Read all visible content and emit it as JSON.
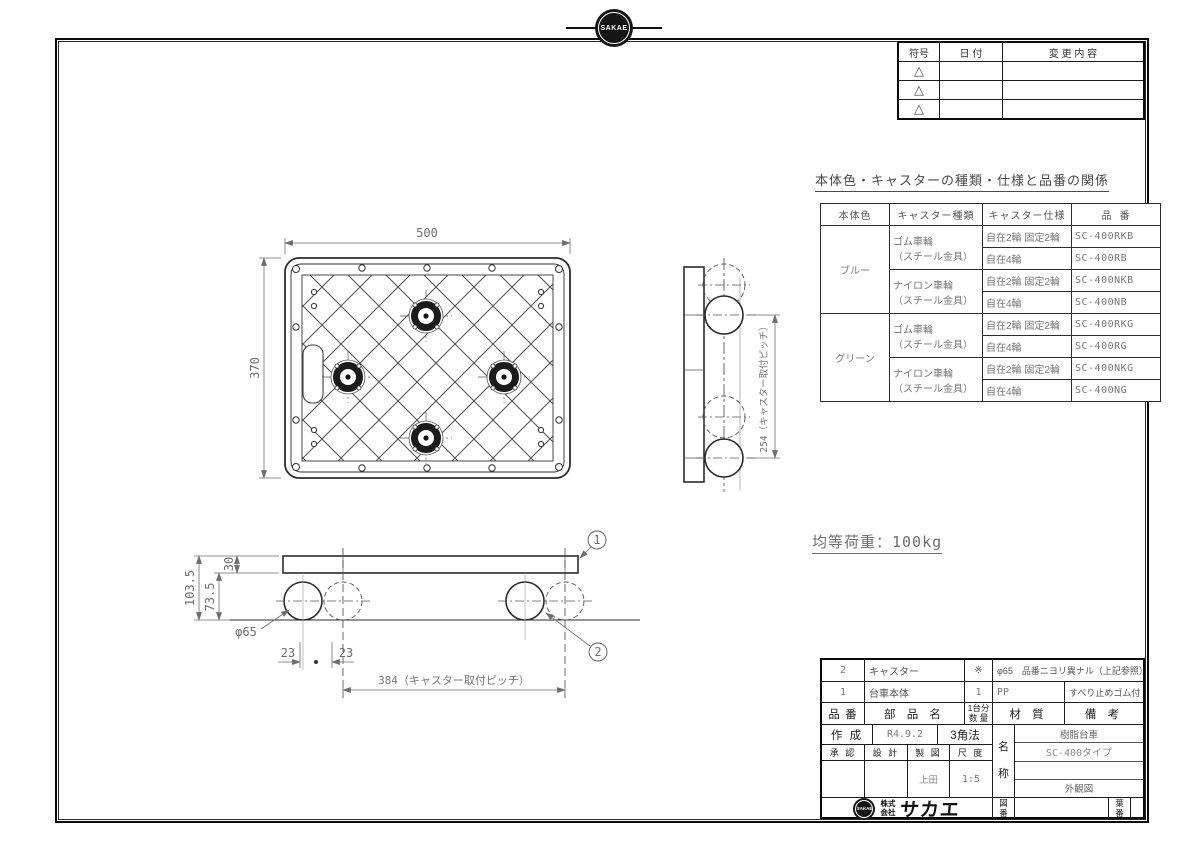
{
  "company": {
    "stamp": "SAKAE",
    "kabushiki": "株式",
    "kaisha": "会社",
    "name": "サカエ"
  },
  "revision_table": {
    "headers": {
      "symbol": "符号",
      "date": "日 付",
      "change": "変 更 内 容"
    },
    "mark": "△"
  },
  "spec_section": {
    "title": "本体色・キャスターの種類・仕様と品番の関係",
    "headers": [
      "本体色",
      "キャスター種類",
      "キャスター仕様",
      "品 番"
    ],
    "rows": [
      {
        "color": "ブルー",
        "type1": "ゴム車輪",
        "type2": "（スチール金具）",
        "spec": "自在2輪 固定2輪",
        "part": "SC-400RKB"
      },
      {
        "spec": "自在4輪",
        "part": "SC-400RB"
      },
      {
        "type1": "ナイロン車輪",
        "type2": "（スチール金具）",
        "spec": "自在2輪 固定2輪",
        "part": "SC-400NKB"
      },
      {
        "spec": "自在4輪",
        "part": "SC-400NB"
      },
      {
        "color": "グリーン",
        "type1": "ゴム車輪",
        "type2": "（スチール金具）",
        "spec": "自在2輪 固定2輪",
        "part": "SC-400RKG"
      },
      {
        "spec": "自在4輪",
        "part": "SC-400RG"
      },
      {
        "type1": "ナイロン車輪",
        "type2": "（スチール金具）",
        "spec": "自在2輪 固定2輪",
        "part": "SC-400NKG"
      },
      {
        "spec": "自在4輪",
        "part": "SC-400NG"
      }
    ]
  },
  "notes": {
    "load": "均等荷重：100kg"
  },
  "parts_table": {
    "headers": {
      "no": "品 番",
      "name": "部 品 名",
      "qty1": "1台分",
      "qty2": "数 量",
      "material": "材   質",
      "remarks": "備   考"
    },
    "rows": [
      {
        "no": "2",
        "name": "キャスター",
        "qty": "※",
        "material": "φ65　品番ニヨリ異ナル（上記参照）",
        "remarks": ""
      },
      {
        "no": "1",
        "name": "台車本体",
        "qty": "1",
        "material": "PP",
        "remarks": "すべり止めゴム付"
      }
    ]
  },
  "title_block": {
    "created_label": "作 成",
    "created_date": "R4.9.2",
    "projection": "3角法",
    "approved_label": "承 認",
    "design_label": "設 計",
    "draft_label": "製 図",
    "scale_label": "尺 度",
    "draft_name": "上田",
    "scale": "1:5",
    "name_label_1": "名",
    "name_label_2": "称",
    "product_name": "樹脂台車",
    "model": "SC-400タイプ",
    "view_type": "外観図",
    "dwg_no_label_1": "図",
    "dwg_no_label_2": "番",
    "sheet_label_1": "葉",
    "sheet_label_2": "番"
  },
  "drawing": {
    "top_view": {
      "width": "500",
      "height": "370"
    },
    "side_view": {
      "pitch": "254（キャスター取付ピッチ）"
    },
    "front_view": {
      "overall_height": "103.5",
      "under_height": "73.5",
      "plate_thickness": "30",
      "wheel_dia": "φ65",
      "offset_l": "23",
      "offset_r": "23",
      "pitch": "384（キャスター取付ピッチ）"
    },
    "balloons": {
      "plate": "1",
      "caster": "2"
    }
  },
  "colors": {
    "line": "#2b2b2b",
    "dim": "#6e6e6e",
    "frame": "#0a0a0a"
  }
}
